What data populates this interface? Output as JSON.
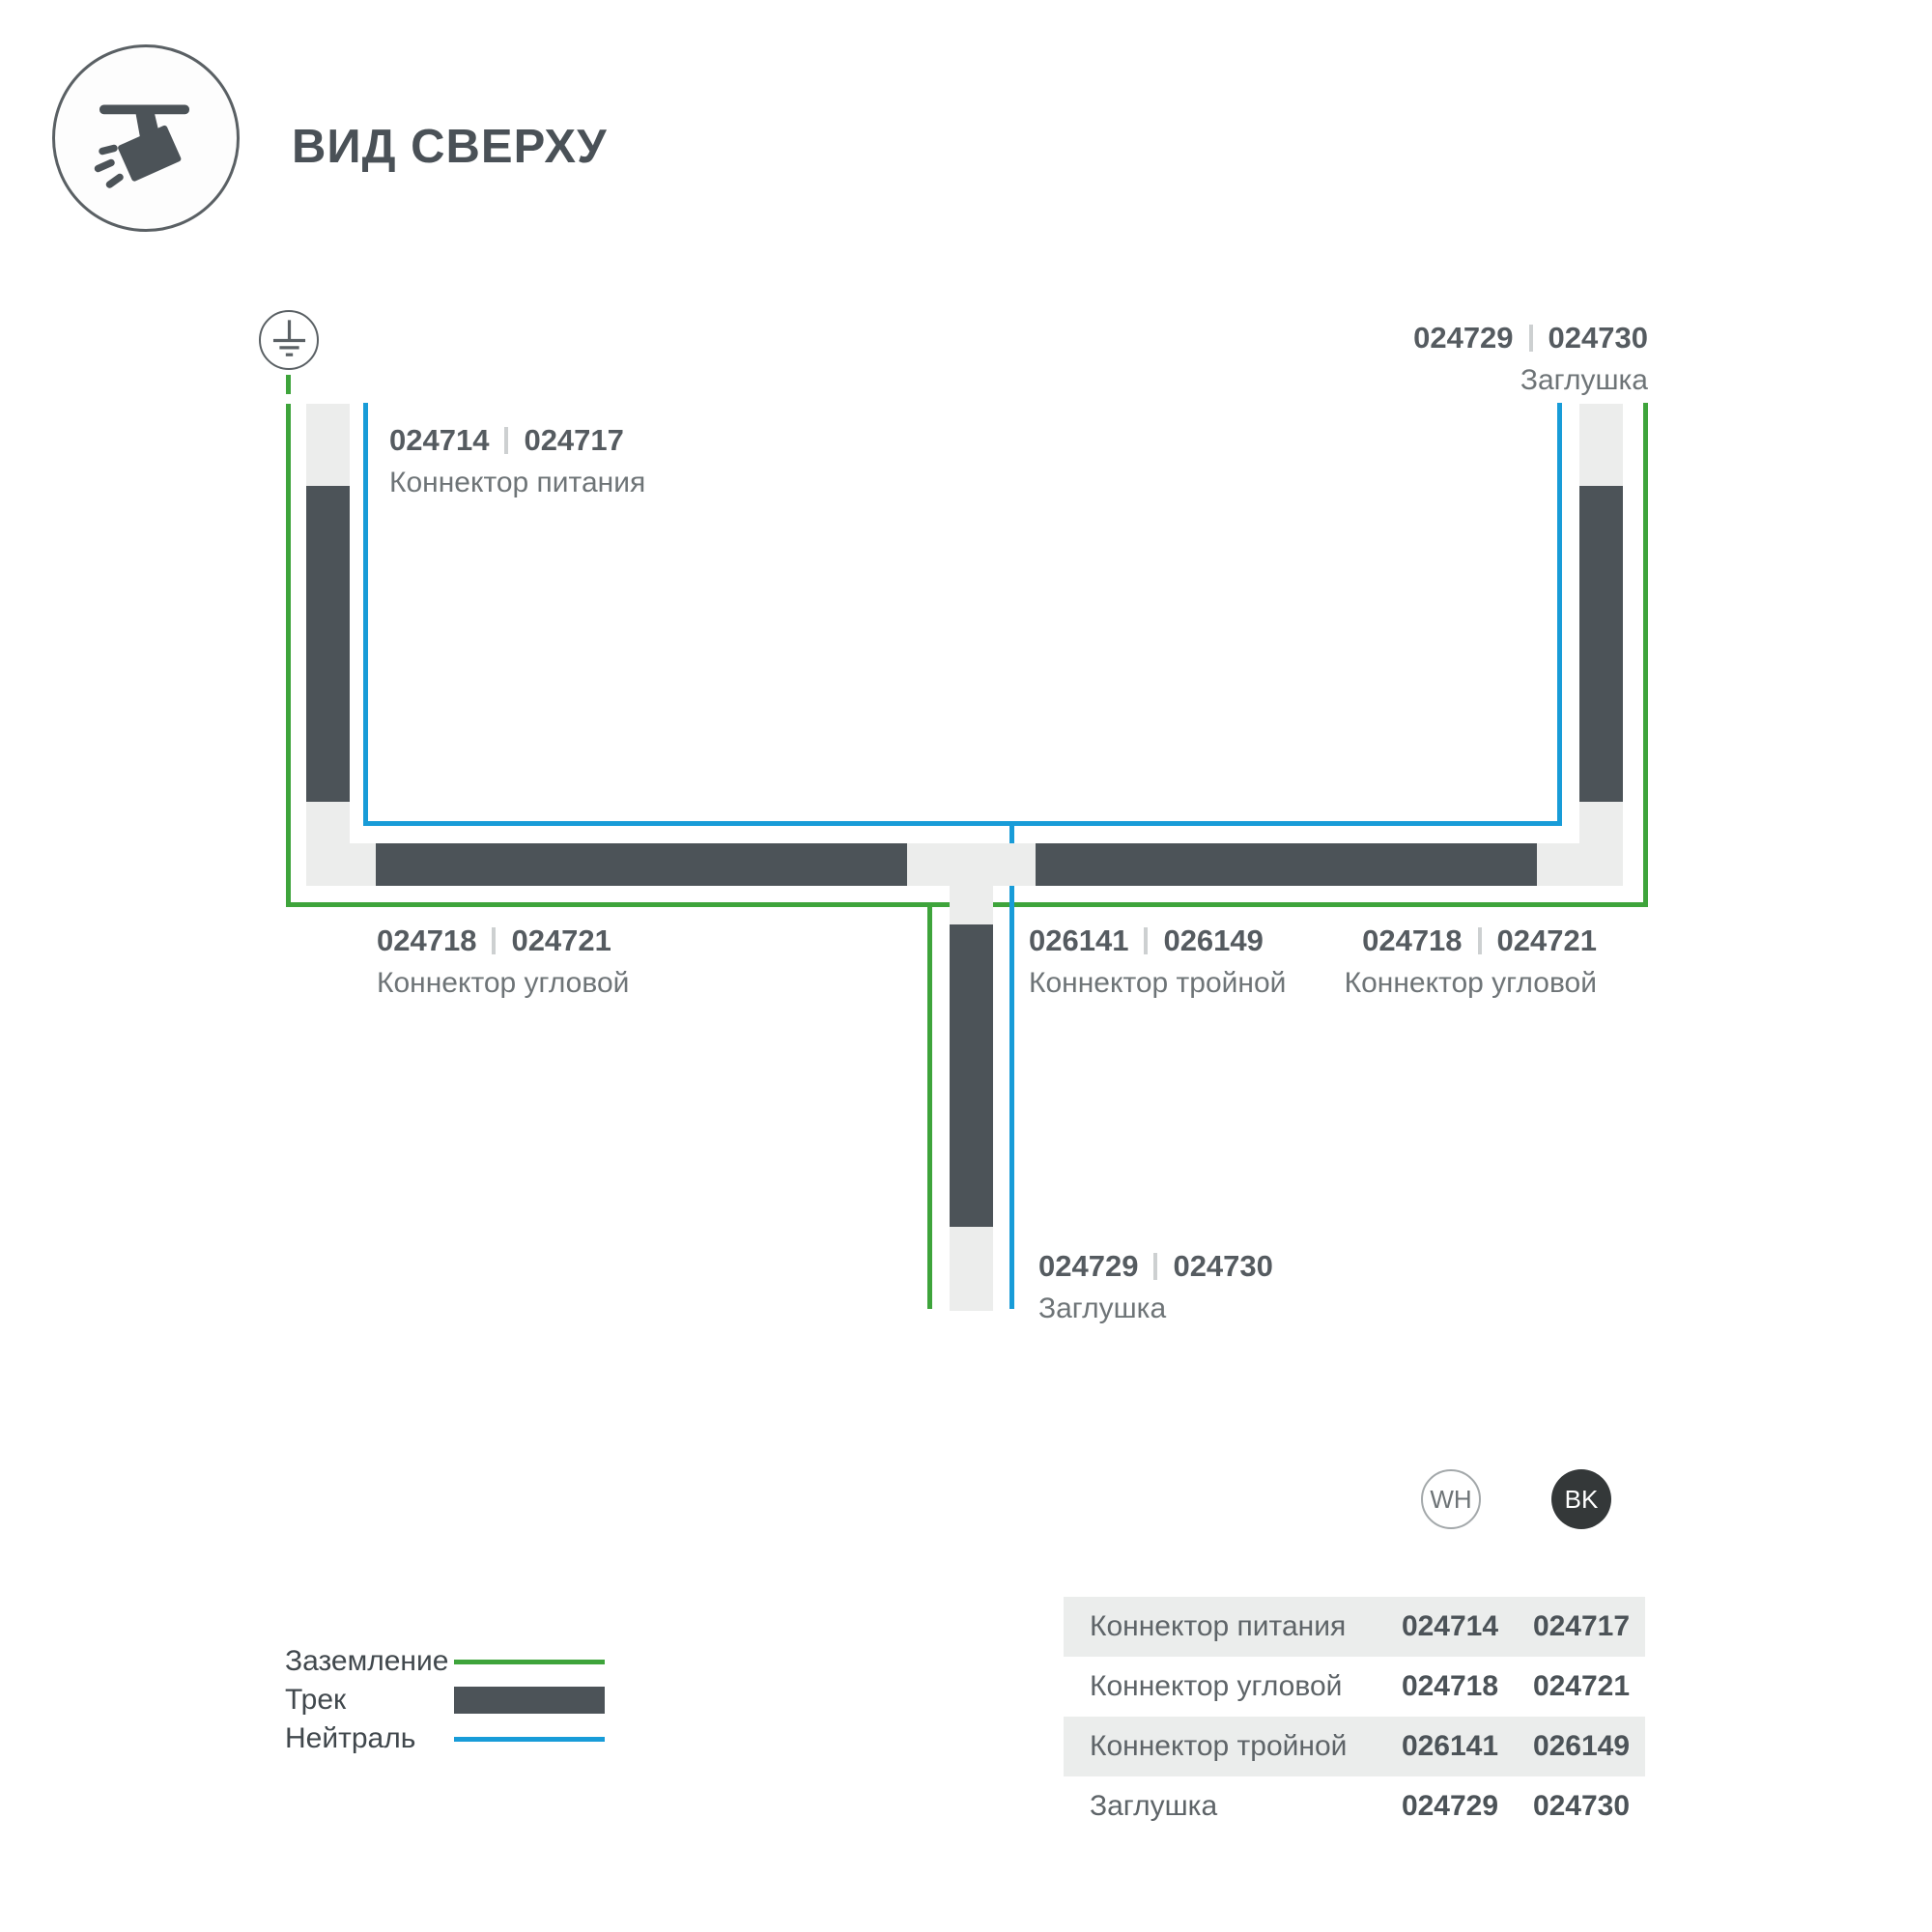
{
  "header": {
    "title": "ВИД СВЕРХУ"
  },
  "labels": {
    "power": {
      "code_a": "024714",
      "code_b": "024717",
      "name": "Коннектор питания"
    },
    "cap_top": {
      "code_a": "024729",
      "code_b": "024730",
      "name": "Заглушка"
    },
    "corner_left": {
      "code_a": "024718",
      "code_b": "024721",
      "name": "Коннектор угловой"
    },
    "triple": {
      "code_a": "026141",
      "code_b": "026149",
      "name": "Коннектор тройной"
    },
    "corner_right": {
      "code_a": "024718",
      "code_b": "024721",
      "name": "Коннектор угловой"
    },
    "cap_bottom": {
      "code_a": "024729",
      "code_b": "024730",
      "name": "Заглушка"
    }
  },
  "legend": {
    "rows": [
      {
        "label": "Заземление",
        "type": "ground-line"
      },
      {
        "label": "Трек",
        "type": "track-bar"
      },
      {
        "label": "Нейтраль",
        "type": "neutral-line"
      }
    ]
  },
  "variants": {
    "wh": "WH",
    "bk": "BK"
  },
  "table": {
    "rows": [
      {
        "name": "Коннектор питания",
        "wh": "024714",
        "bk": "024717"
      },
      {
        "name": "Коннектор угловой",
        "wh": "024718",
        "bk": "024721"
      },
      {
        "name": "Коннектор тройной",
        "wh": "026141",
        "bk": "026149"
      },
      {
        "name": "Заглушка",
        "wh": "024729",
        "bk": "024730"
      }
    ]
  },
  "colors": {
    "track_dark": "#4C5358",
    "track_light": "#ECEDEC",
    "ground_green": "#3EA43B",
    "neutral_blue": "#189CD8"
  }
}
